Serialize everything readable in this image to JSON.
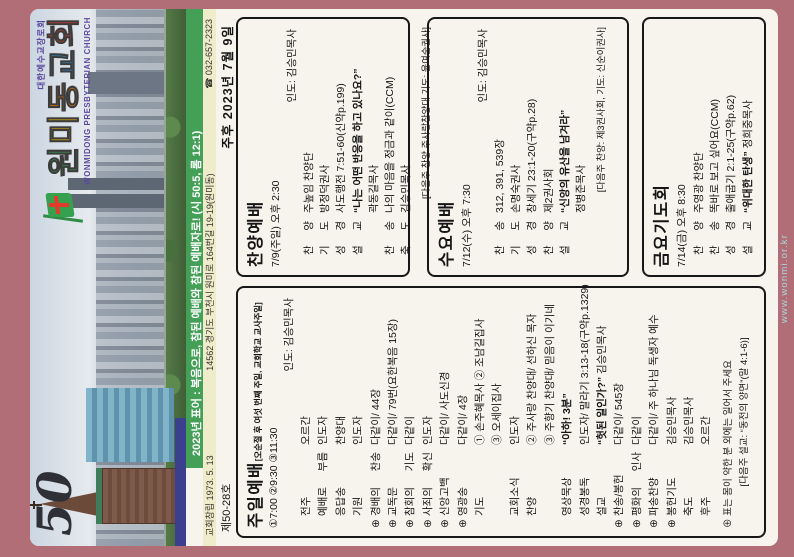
{
  "url": "www.wonmi.or.kr",
  "header": {
    "anniversary": "50",
    "denomination": "대한예수교장로회",
    "church_name_chars": [
      {
        "ch": "원",
        "color": "#35a14f"
      },
      {
        "ch": "미",
        "color": "#f2b705"
      },
      {
        "ch": "동",
        "color": "#ef7d00"
      },
      {
        "ch": "교",
        "color": "#2f86c4"
      },
      {
        "ch": "회",
        "color": "#e23b2c"
      }
    ],
    "church_name_en": "WONMIDONG PRESBYTERIAN CHURCH",
    "motto": "2023년 표어 : 복음으로, 참된 예배와 참된 예배자로! (시 50:5, 롬 12:1)",
    "founded": "교회창립 1973. 5. 13",
    "address": "14562 경기도 부천시 원미로 164번길 19-19(원미동)",
    "phone": "☎ 032-657-2323",
    "issue_no": "제50-28호",
    "date": "주후 2023년 7월 9일"
  },
  "sections": {
    "sunday": {
      "title": "주일예배",
      "note": "[오순절 후 여섯 번째 주일, 교회학교 교사주일]",
      "times": "①7:00 ②9:30 ③11:30",
      "leader": "인도: 김승민목사",
      "rows": [
        {
          "m": "",
          "l": "전주",
          "v": "오르간"
        },
        {
          "m": "",
          "l": "예배로 부름",
          "v": "인도자"
        },
        {
          "m": "",
          "l": "응답송",
          "v": "찬양대"
        },
        {
          "m": "",
          "l": "기원",
          "v": "인도자"
        },
        {
          "m": "⊕",
          "l": "경배의 찬송",
          "v": "다같이/ 44장"
        },
        {
          "m": "⊕",
          "l": "교독문",
          "v": "다같이/ 79번(요한복음 15장)"
        },
        {
          "m": "⊕",
          "l": "참회의 기도",
          "v": "다같이"
        },
        {
          "m": "⊕",
          "l": "사죄의 확신",
          "v": "인도자"
        },
        {
          "m": "⊕",
          "l": "신앙고백",
          "v": "다같이/ 사도신경"
        },
        {
          "m": "⊕",
          "l": "영광송",
          "v": "다같이/ 4장"
        },
        {
          "m": "",
          "l": "기도",
          "v": "① 손주혜목사  ② 조남길집사"
        },
        {
          "m": "",
          "l": "",
          "v": "③ 오세이집사"
        },
        {
          "m": "",
          "l": "교회소식",
          "v": "인도자"
        },
        {
          "m": "",
          "l": "찬양",
          "v": "② 주사랑 찬양대/ 선하신 목자"
        },
        {
          "m": "",
          "l": "",
          "v": "③ 주향기 찬양대/ 믿음이 이기네"
        },
        {
          "m": "",
          "l": "영상묵상",
          "b": "“아하! 3분”",
          "v": ""
        },
        {
          "m": "",
          "l": "성경봉독",
          "v": "인도자/ 말라기 3:13-18(구약p.1329)"
        },
        {
          "m": "",
          "l": "설교",
          "b": "“헛된 일인가?”",
          "v": " 김승민목사"
        },
        {
          "m": "⊕",
          "l": "찬송/봉헌",
          "v": "다같이/ 545장"
        },
        {
          "m": "⊕",
          "l": "평화의 인사",
          "v": "다같이"
        },
        {
          "m": "⊕",
          "l": "파송찬양",
          "v": "다같이/ 주 하나님 독생자 예수"
        },
        {
          "m": "⊕",
          "l": "봉헌기도",
          "v": "김승민목사"
        },
        {
          "m": "",
          "l": "축도",
          "v": "김승민목사"
        },
        {
          "m": "",
          "l": "후주",
          "v": "오르간"
        }
      ],
      "footnote1": "⊕ 표는 몸이 약한 분 외에는 일어서 주세요",
      "footnote2": "[다음주 설교: “동전의 양면”(말 4:1-6)]"
    },
    "praise": {
      "title": "찬양예배",
      "time": "7/9(주일) 오후 2:30",
      "leader": "인도: 김승민목사",
      "rows": [
        {
          "m": "",
          "l": "찬 양",
          "v": "주높임 찬양단"
        },
        {
          "m": "",
          "l": "기 도",
          "v": "방정덕권사"
        },
        {
          "m": "",
          "l": "성 경",
          "v": "사도행전 7:51-60(신약p.199)"
        },
        {
          "m": "",
          "l": "설 교",
          "b": "“나는 어떤 반응을 하고 있나요?”",
          "v": ""
        },
        {
          "m": "",
          "l": "",
          "v": "곽동길목사"
        },
        {
          "m": "",
          "l": "찬 송",
          "v": "나의 마음을 정금과 같이(CCM)"
        },
        {
          "m": "",
          "l": "축 도",
          "v": "김승민목사"
        }
      ],
      "footer": "[다음주 찬양 주사랑찬양대 기도: 윤여순권사]"
    },
    "wednesday": {
      "title": "수요예배",
      "time": "7/12(수) 오후 7:30",
      "leader": "인도: 김승민목사",
      "rows": [
        {
          "m": "",
          "l": "찬 송",
          "v": "312, 391, 539장"
        },
        {
          "m": "",
          "l": "기 도",
          "v": "손명숙권사"
        },
        {
          "m": "",
          "l": "성 경",
          "v": "창세기 23:1-20(구약p.28)"
        },
        {
          "m": "",
          "l": "찬 양",
          "v": "제2권사회"
        },
        {
          "m": "",
          "l": "설 교",
          "b": "“신앙의 유산을 남겨라”",
          "v": ""
        },
        {
          "m": "",
          "l": "",
          "v": "정병준목사"
        }
      ],
      "footer": "[다음주 찬양: 제3권사회, 기도: 신순이권사]"
    },
    "friday": {
      "title": "금요기도회",
      "time": "7/14(금) 오후 8:30",
      "rows": [
        {
          "m": "",
          "l": "찬 양",
          "v": "주영광 찬양단"
        },
        {
          "m": "",
          "l": "찬 송",
          "v": "똑바로 보고 싶어요(CCM)"
        },
        {
          "m": "",
          "l": "성 경",
          "v": "출애굽기 2:1-25(구약p.62)"
        },
        {
          "m": "",
          "l": "설 교",
          "b": "“위대한 탄생”",
          "v": " 정희중목사"
        }
      ]
    }
  }
}
